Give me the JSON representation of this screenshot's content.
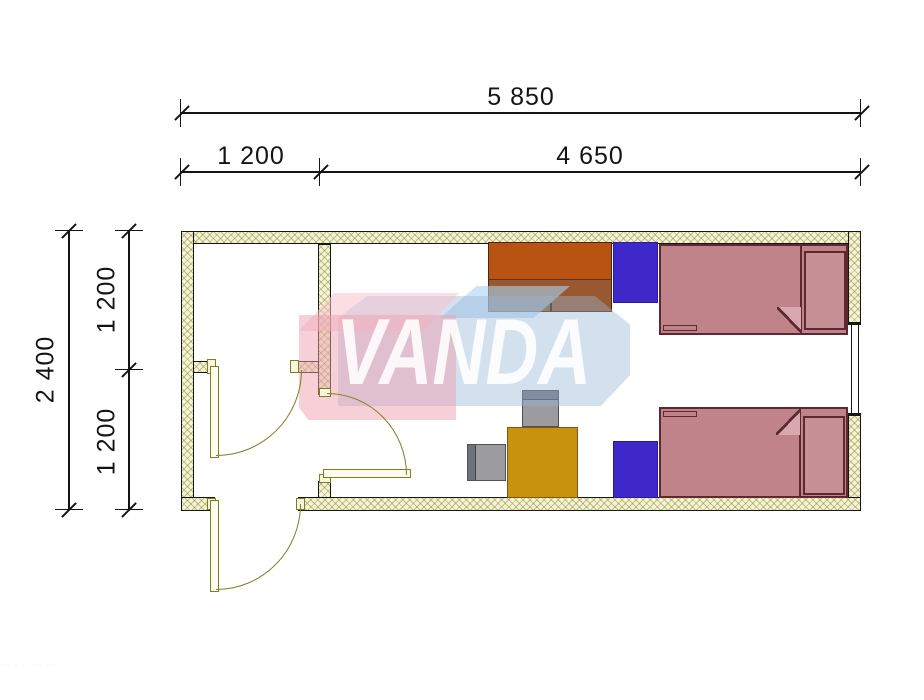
{
  "drawing": {
    "type": "floor-plan",
    "units": "mm"
  },
  "dimensions": {
    "horizontal": {
      "total": "5 850",
      "segments": [
        "1 200",
        "4 650"
      ]
    },
    "vertical": {
      "total": "2 400",
      "segments": [
        "1 200",
        "1 200"
      ]
    }
  },
  "watermark": {
    "text": "VANDA"
  },
  "footer": {
    "note": "··· ··  ·· ···· ···"
  },
  "legend": {
    "items": [
      "wardrobe",
      "nightstand",
      "bed",
      "desk",
      "chair",
      "door",
      "window",
      "wall"
    ]
  },
  "colors": {
    "dim": "#141414",
    "outline": "#161616",
    "wall_fill": "#F4F3D6",
    "wall_hatch": "rgba(140,140,50,0.5)",
    "door": "#7E7E20",
    "wardrobe_top": "#B85311",
    "wardrobe_bottom": "#9A5830",
    "nightstand": "#3E28C9",
    "bed_fill": "#C0838A",
    "bed_outline": "#5E2831",
    "desk": "#C8920F",
    "chair": "#9C9CA0",
    "chair_dark": "#70727A",
    "wm_pink": "rgba(238,160,175,0.50)",
    "wm_pink_top": "rgba(246,195,205,0.55)",
    "wm_blue": "rgba(150,180,212,0.42)",
    "wm_blue_top": "rgba(168,210,240,0.60)",
    "wm_text": "rgba(255,255,255,0.88)"
  }
}
